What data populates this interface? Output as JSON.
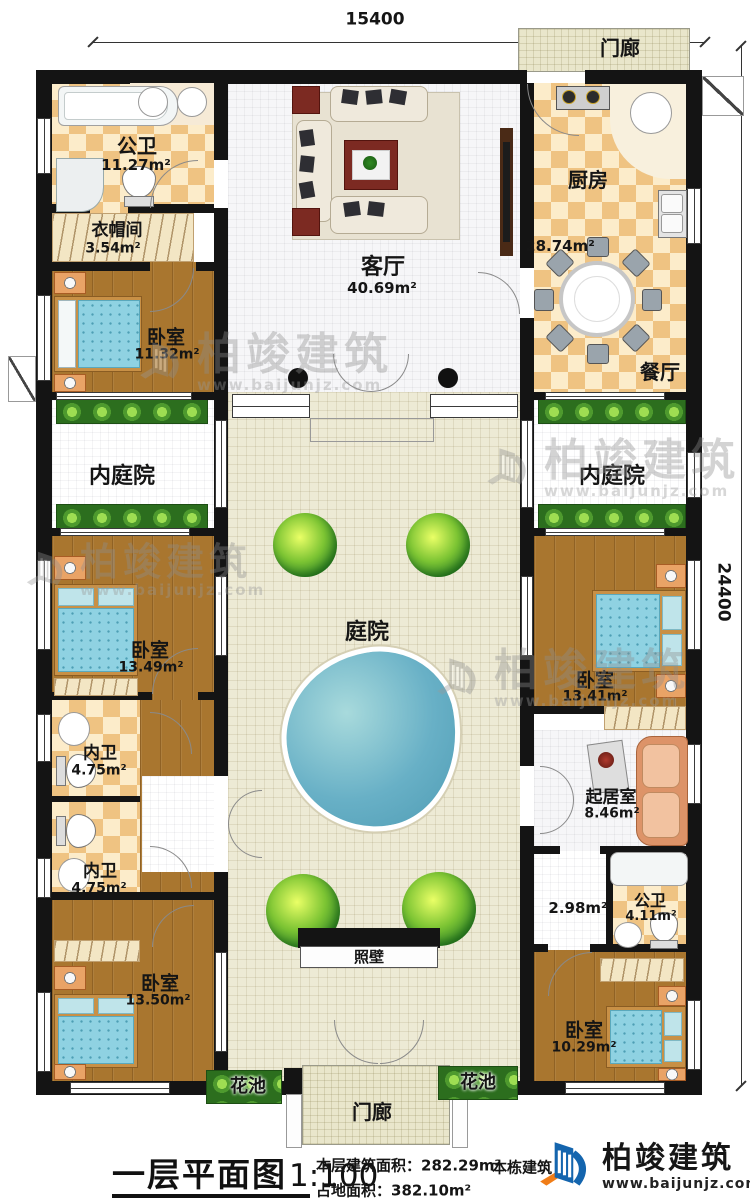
{
  "plan": {
    "dims": {
      "width_mm": "15400",
      "depth_mm": "24400"
    },
    "rooms": {
      "porch_top": {
        "label": "门廊"
      },
      "porch_bottom": {
        "label": "门廊"
      },
      "public_bath_top": {
        "label": "公卫",
        "area": "11.27m²"
      },
      "cloakroom": {
        "label": "衣帽间",
        "area": "3.54m²"
      },
      "bedroom_a": {
        "label": "卧室",
        "area": "11.32m²"
      },
      "living_room": {
        "label": "客厅",
        "area": "40.69m²"
      },
      "kitchen": {
        "label": "厨房",
        "area": "28.74m²"
      },
      "dining_room": {
        "label": "餐厅"
      },
      "inner_courtyard_left": {
        "label": "内庭院"
      },
      "inner_courtyard_right": {
        "label": "内庭院"
      },
      "courtyard": {
        "label": "庭院"
      },
      "bedroom_b": {
        "label": "卧室",
        "area": "13.49m²"
      },
      "bedroom_c": {
        "label": "卧室",
        "area": "13.41m²"
      },
      "inner_bath_a": {
        "label": "内卫",
        "area": "4.75m²"
      },
      "inner_bath_b": {
        "label": "内卫",
        "area": "4.75m²"
      },
      "sitting_room": {
        "label": "起居室",
        "area": "8.46m²"
      },
      "hall": {
        "area": "2.98m²"
      },
      "public_bath_bottom": {
        "label": "公卫",
        "area": "4.11m²"
      },
      "bedroom_d": {
        "label": "卧室",
        "area": "13.50m²"
      },
      "bedroom_e": {
        "label": "卧室",
        "area": "10.29m²"
      },
      "screen_wall": {
        "label": "照壁"
      },
      "flower_bed_left": {
        "label": "花池"
      },
      "flower_bed_right": {
        "label": "花池"
      }
    }
  },
  "footer": {
    "title": "一层平面图",
    "scale": "1:100",
    "floor_area_label": "本层建筑面积：",
    "floor_area_value": "282.29m²",
    "land_area_label": "占地面积：",
    "land_area_value": "382.10m²",
    "total_area_label": "本栋建筑",
    "brand": "柏竣建筑",
    "website": "www.baijunjz.com"
  },
  "watermark": {
    "brand": "柏竣建筑",
    "website": "www.baijunjz.com"
  },
  "colors": {
    "wall": "#141414",
    "tile_check": "#efc382",
    "wood": "#a9762f",
    "water": "#68b0c6",
    "planter": "#2c6e1e",
    "brand_blue": "#1465ae",
    "brand_orange": "#f07d18"
  }
}
